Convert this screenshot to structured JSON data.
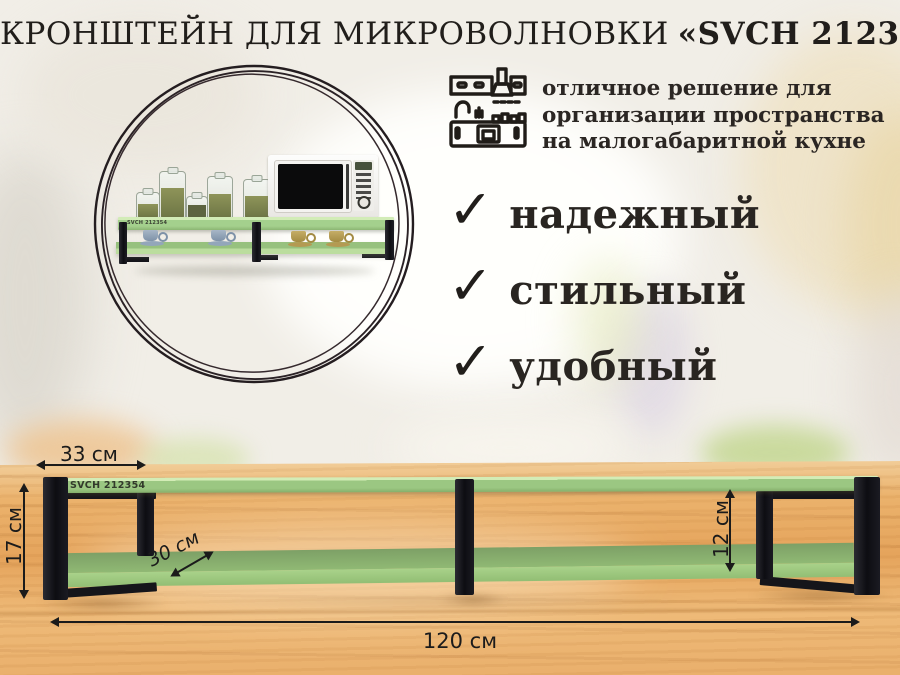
{
  "title": {
    "product_type": "КРОНШТЕЙН ДЛЯ МИКРОВОЛНОВКИ",
    "model": "«SVCH 212354»"
  },
  "intro": {
    "text": "отличное решение для организации пространства на малогабаритной кухне"
  },
  "features": [
    {
      "label": "надежный"
    },
    {
      "label": "стильный"
    },
    {
      "label": "удобный"
    }
  ],
  "icons": {
    "check": "✓",
    "kitchen": "kitchen-furniture-line-icon"
  },
  "product": {
    "board_label": "SVCH 212354"
  },
  "dimensions": {
    "bracket_depth": "33 см",
    "total_height": "17 см",
    "shelf_depth": "30 см",
    "tier_gap": "12 см",
    "total_width": "120 см"
  },
  "colors": {
    "shelf_green": "#9bc782",
    "bracket_black": "#17171c",
    "wood_table": "#e8ab64",
    "annotation": "#1b1b1b",
    "background_cream": "#f1eee7"
  }
}
